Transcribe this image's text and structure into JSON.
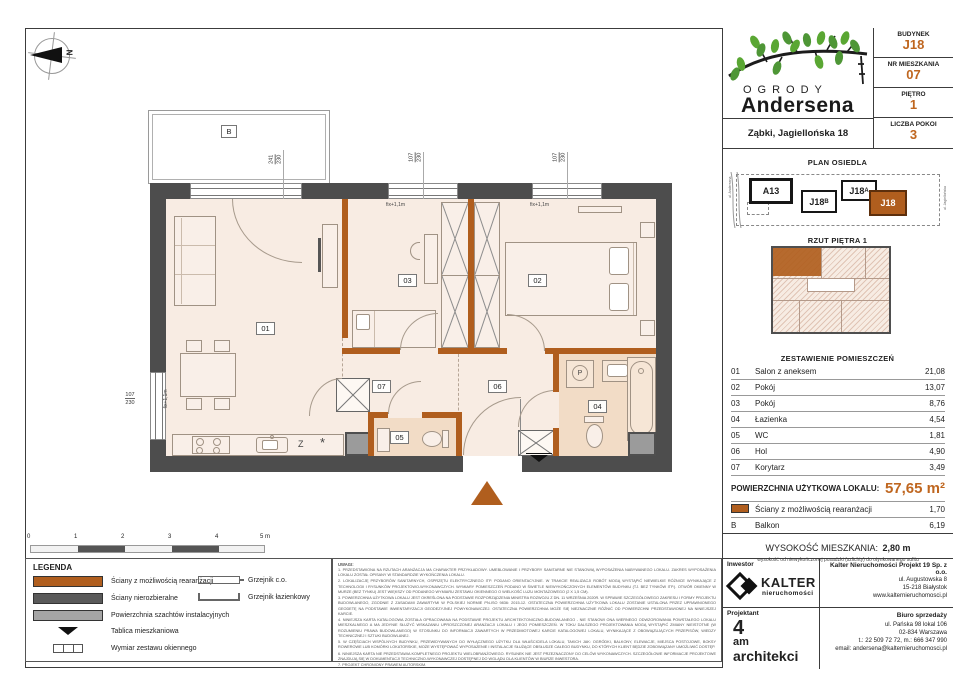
{
  "header": {
    "brand_top": "OGRODY",
    "brand_bottom": "Andersena",
    "address": "Ząbki, Jagiellońska 18",
    "info_rows": [
      {
        "label": "BUDYNEK",
        "value": "J18"
      },
      {
        "label": "NR MIESZKANIA",
        "value": "07"
      },
      {
        "label": "PIĘTRO",
        "value": "1"
      },
      {
        "label": "LICZBA POKOI",
        "value": "3"
      }
    ]
  },
  "site_plan": {
    "title": "PLAN OSIEDLA",
    "buildings": [
      {
        "label": "A13",
        "sub": ""
      },
      {
        "label": "J18",
        "sub": "B"
      },
      {
        "label": "J18",
        "sub": "A"
      },
      {
        "label": "J18",
        "sub": ""
      }
    ],
    "street_left": "ul. Andersena",
    "street_right": "ul. Jagiellońska"
  },
  "floor_plan_thumb": {
    "title": "RZUT PIĘTRA 1"
  },
  "rooms_table": {
    "title": "ZESTAWIENIE POMIESZCZEŃ",
    "rows": [
      {
        "no": "01",
        "name": "Salon z aneksem",
        "area": "21,08"
      },
      {
        "no": "02",
        "name": "Pokój",
        "area": "13,07"
      },
      {
        "no": "03",
        "name": "Pokój",
        "area": "8,76"
      },
      {
        "no": "04",
        "name": "Łazienka",
        "area": "4,54"
      },
      {
        "no": "05",
        "name": "WC",
        "area": "1,81"
      },
      {
        "no": "06",
        "name": "Hol",
        "area": "4,90"
      },
      {
        "no": "07",
        "name": "Korytarz",
        "area": "3,49"
      }
    ],
    "total_label": "POWIERZCHNIA UŻYTKOWA LOKALU:",
    "total_value": "57,65 m²",
    "walls_row": {
      "label": "Ściany z możliwością rearanżacji",
      "area": "1,70"
    },
    "balcony_row": {
      "no": "B",
      "label": "Balkon",
      "area": "6,19"
    }
  },
  "height_info": {
    "label": "WYSOKOŚĆ MIESZKANIA:",
    "value": "2,80 m",
    "note": "wysokość od niewykończonej posadzki (szlichty) do otynkowanego sufitu"
  },
  "footer": {
    "investor_label": "Inwestor",
    "investor_name": "KALTER",
    "investor_sub": "nieruchomości",
    "company_name": "Kalter Nieruchomości Projekt 19 Sp. z o.o.",
    "company_lines": [
      "ul. Augustowska 8",
      "15-218 Białystok",
      "www.kalternieruchomosci.pl"
    ],
    "designer_label": "Projektant",
    "designer_logo": [
      "4",
      "am",
      "architekci"
    ],
    "sales_label": "Biuro sprzedaży",
    "sales_lines": [
      "ul. Pańska 98 lokal 106",
      "02-834 Warszawa",
      "t.: 22 509 72 72, m.: 666 347 990",
      "email: andersena@kalternieruchomosci.pl"
    ]
  },
  "legend": {
    "title": "LEGENDA",
    "items_left": [
      "Ściany z możliwością rearanżacji",
      "Ściany nierozbieralne",
      "Powierzchnia szachtów instalacyjnych",
      "Tablica mieszkaniowa",
      "Wymiar zestawu okiennego"
    ],
    "items_right": [
      "Grzejnik c.o.",
      "Grzejnik łazienkowy"
    ]
  },
  "notes": {
    "title": "UWAGI:",
    "items": [
      "1. PRZEDSTAWIONA NA RZUTACH ARANŻACJA MA CHARAKTER PRZYKŁADOWY. UMEBLOWANIE I PRZYBORY SANITARNE NIE STANOWIĄ WYPOSAŻENIA NABYWANEGO LOKALU. ZAKRES WYPOSAŻENIA LOKALU ZOSTAŁ OPISANY W STANDARDZIE WYKOŃCZENIA LOKALU.",
      "2. LOKALIZACJĘ PRZYBORÓW SANITARNYCH, OSPRZĘTU ELEKTRYCZNEGO ITP. PODANO ORIENTACYJNIE. W TRAKCIE REALIZACJI ROBÓT MOGĄ WYSTĄPIĆ NIEWIELKIE RÓŻNICE WYNIKAJĄCE Z TECHNOLOGII I RYSUNKÓW PROJEKTOWO-WYKONAWCZYCH. WYMIARY POMIESZCZEŃ PODANO W ŚWIETLE NIEWYKOŃCZONYCH ELEMENTÓW BUDYNKU (TJ. BEZ TYNKÓW ITP.). OTWÓR OKIENNY W MURZE (BEZ TYNKU) JEST WIĘKSZY OD PODANEGO WYMIARU ZESTAWU OKIENNEGO O WIELKOŚĆ LUZU MONTAŻOWEGO (2 X 1,5 CM).",
      "3. POWIERZCHNIA UŻYTKOWA LOKALU JEST OKREŚLONA NA PODSTAWIE ROZPORZĄDZENIA MINISTRA ROZWOJU Z DN. 11 WRZEŚNIA 2020R. W SPRAWIE SZCZEGÓŁOWEGO ZAKRESU I FORMY PROJEKTU BUDOWLANEGO, ZGODNIE Z ZASADAMI ZAWARTYMI W POLSKIEJ NORMIE PN-ISO 9836: 2015-12. OSTATECZNA POWIERZCHNIA UŻYTKOWA LOKALU ZOSTANIE USTALONA PRZEZ UPRAWNIONEGO GEODETĘ NA PODSTAWIE INWENTARYZACJI GEODEZYJNEJ POWYKONAWCZEJ. OSTATECZNA POWIERZCHNIA MOŻE SIĘ NIEZNACZNIE RÓŻNIĆ OD POWIERZCHNI PRZEDSTAWIONEJ NA NINIEJSZEJ KARCIE.",
      "4. NINIEJSZA KARTA KATALOGOWA ZOSTAŁA OPRACOWANA NA PODSTAWIE PROJEKTU ARCHITEKTONICZNO-BUDOWLANEGO - NIE STANOWI ONA WIERNEGO ODWZOROWANIA POWSTAŁEGO LOKALU MIESZKALNEGO A MA JEDYNIE SŁUŻYĆ WSKAZANIU UPROSZCZONEJ ARANŻACJI LOKALU I JEGO POMIESZCZEŃ. W TOKU DALSZEGO PROJEKTOWANIA MOGĄ WYSTĄPIĆ ZMIANY NIEISTOTNE (W ROZUMIENIU PRAWA BUDOWLANEGO) W STOSUNKU DO INFORMACJI ZAWARTYCH W PRZEDMIOTOWEJ KARCIE KATALOGOWEJ LOKALU, WYNIKAJĄCE Z OBOWIĄZUJĄCYCH PRZEPISÓW, WIEDZY TECHNICZNEJ I SZTUKI BUDOWLANEJ.",
      "5. W CZĘŚCIACH WSPÓLNYCH BUDYNKU, PRZEWIDYWANYCH DO WYŁĄCZNEGO UŻYTKU DLA WŁAŚCICIELA LOKALU, TAKICH JAK: OGRÓDKI, BALKONY, ELEWACJE, MIEJSCA POSTOJOWE, BOKSY ROWEROWE LUB KOMÓRKI LOKATORSKIE, MOŻE WYSTĘPOWAĆ WYPOSAŻENIE I INSTALACJE SŁUŻĄCE OBSŁUDZE CAŁEGO BUDYNKU, DO KTÓRYCH KLIENT BĘDZIE ZOBOWIĄZANY UMOŻLIWIĆ DOSTĘP.",
      "6. NINIEJSZA KARTA NIE PRZEDSTAWIA KOMPLETNEGO PROJEKTU WIELOBRANŻOWEGO. RYSUNEK NIE JEST PRZEZNACZONY DO CELÓW WYKONAWCZYCH. SZCZEGÓŁOWE INFORMACJE PROJEKTOWE ZNAJDUJĄ SIĘ W DOKUMENTACJI TECHNICZNO-WYKONAWCZEJ DOSTĘPNEJ DO WGLĄDU DLA KLIENTÓW W BIURZE INWESTORA.",
      "7. PROJEKT CHRONIONY PRAWEM AUTORSKIM."
    ]
  },
  "scale_bar": {
    "ticks": [
      "0",
      "1",
      "2",
      "3",
      "4",
      "5 m"
    ]
  },
  "plan": {
    "compass": "N",
    "balcony_label": "B",
    "room_labels": [
      "01",
      "02",
      "03",
      "04",
      "05",
      "06",
      "07"
    ],
    "window_dims": [
      {
        "w": "241",
        "h": "230"
      },
      {
        "w": "107",
        "h": "230"
      },
      {
        "w": "107",
        "h": "230"
      },
      {
        "w": "107",
        "h": "230"
      }
    ],
    "fix_label": "fix+1,1m",
    "kitchen": {
      "dishwasher": "Z",
      "fridge": "*"
    },
    "washer": "P"
  },
  "colors": {
    "accent": "#bf661f",
    "wall_dark": "#4d4d4d",
    "wall_reconfig": "#b05e1e",
    "shaft_gray": "#9b9b9b",
    "room_fill": "#f8ece3",
    "bath_fill": "#f2dcc6"
  }
}
